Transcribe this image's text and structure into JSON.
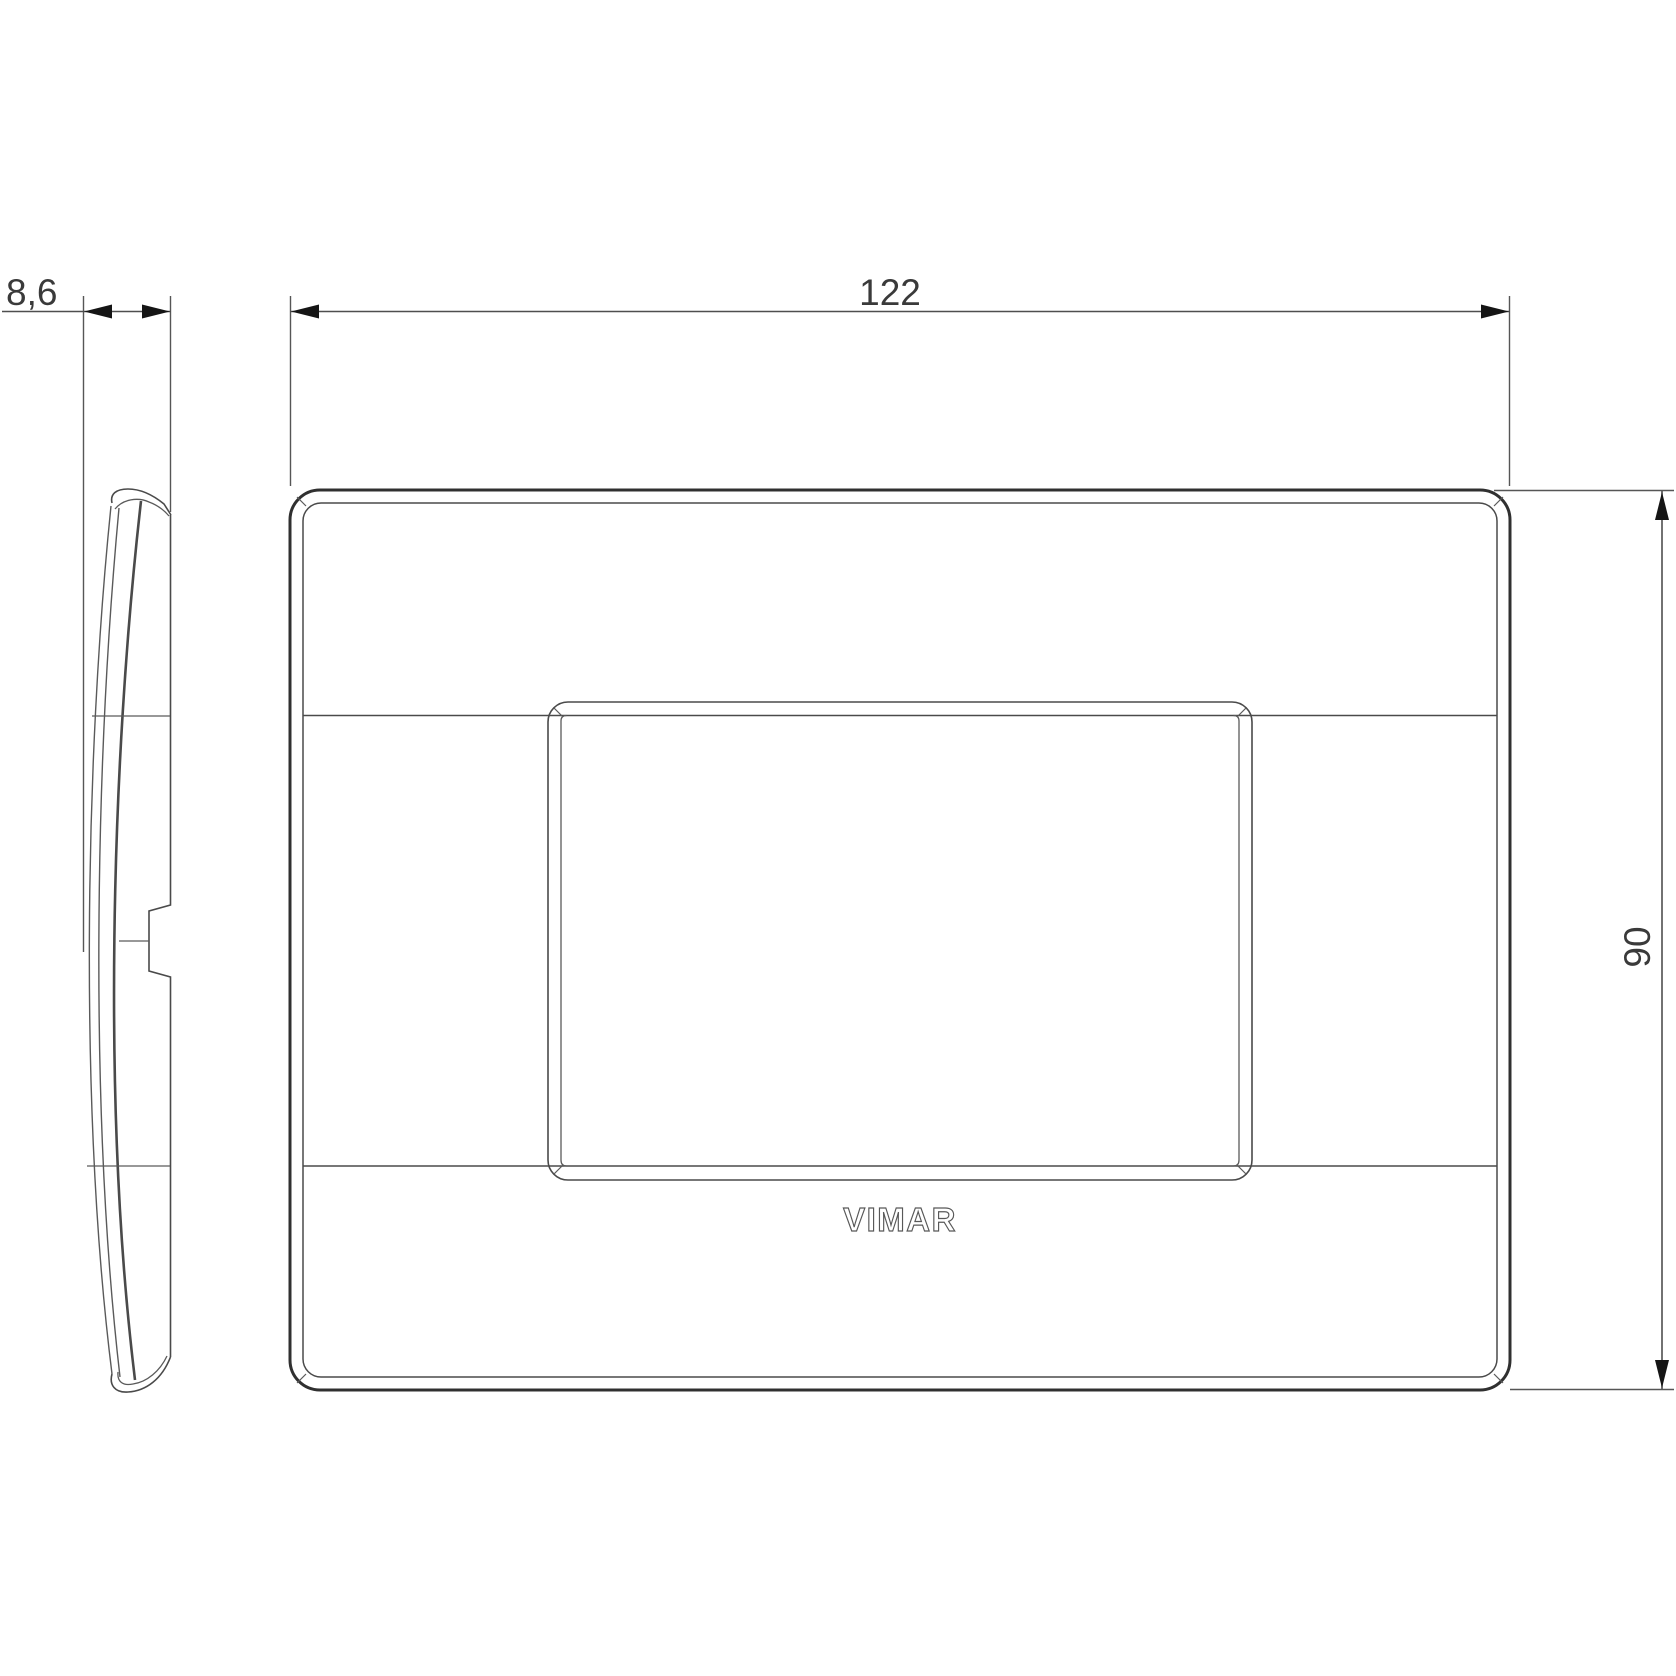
{
  "drawing": {
    "brand_logo": "VIMAR",
    "dimensions": {
      "thickness": "8,6",
      "width": "122",
      "height": "90"
    },
    "colors": {
      "background": "#ffffff",
      "plate_outline": "#303030",
      "detail_line": "#4a4a4a",
      "dimension_line": "#4f4f4f",
      "arrow": "#151515",
      "dimension_text": "#3a3a3a",
      "logo_outline": "#585858"
    }
  }
}
